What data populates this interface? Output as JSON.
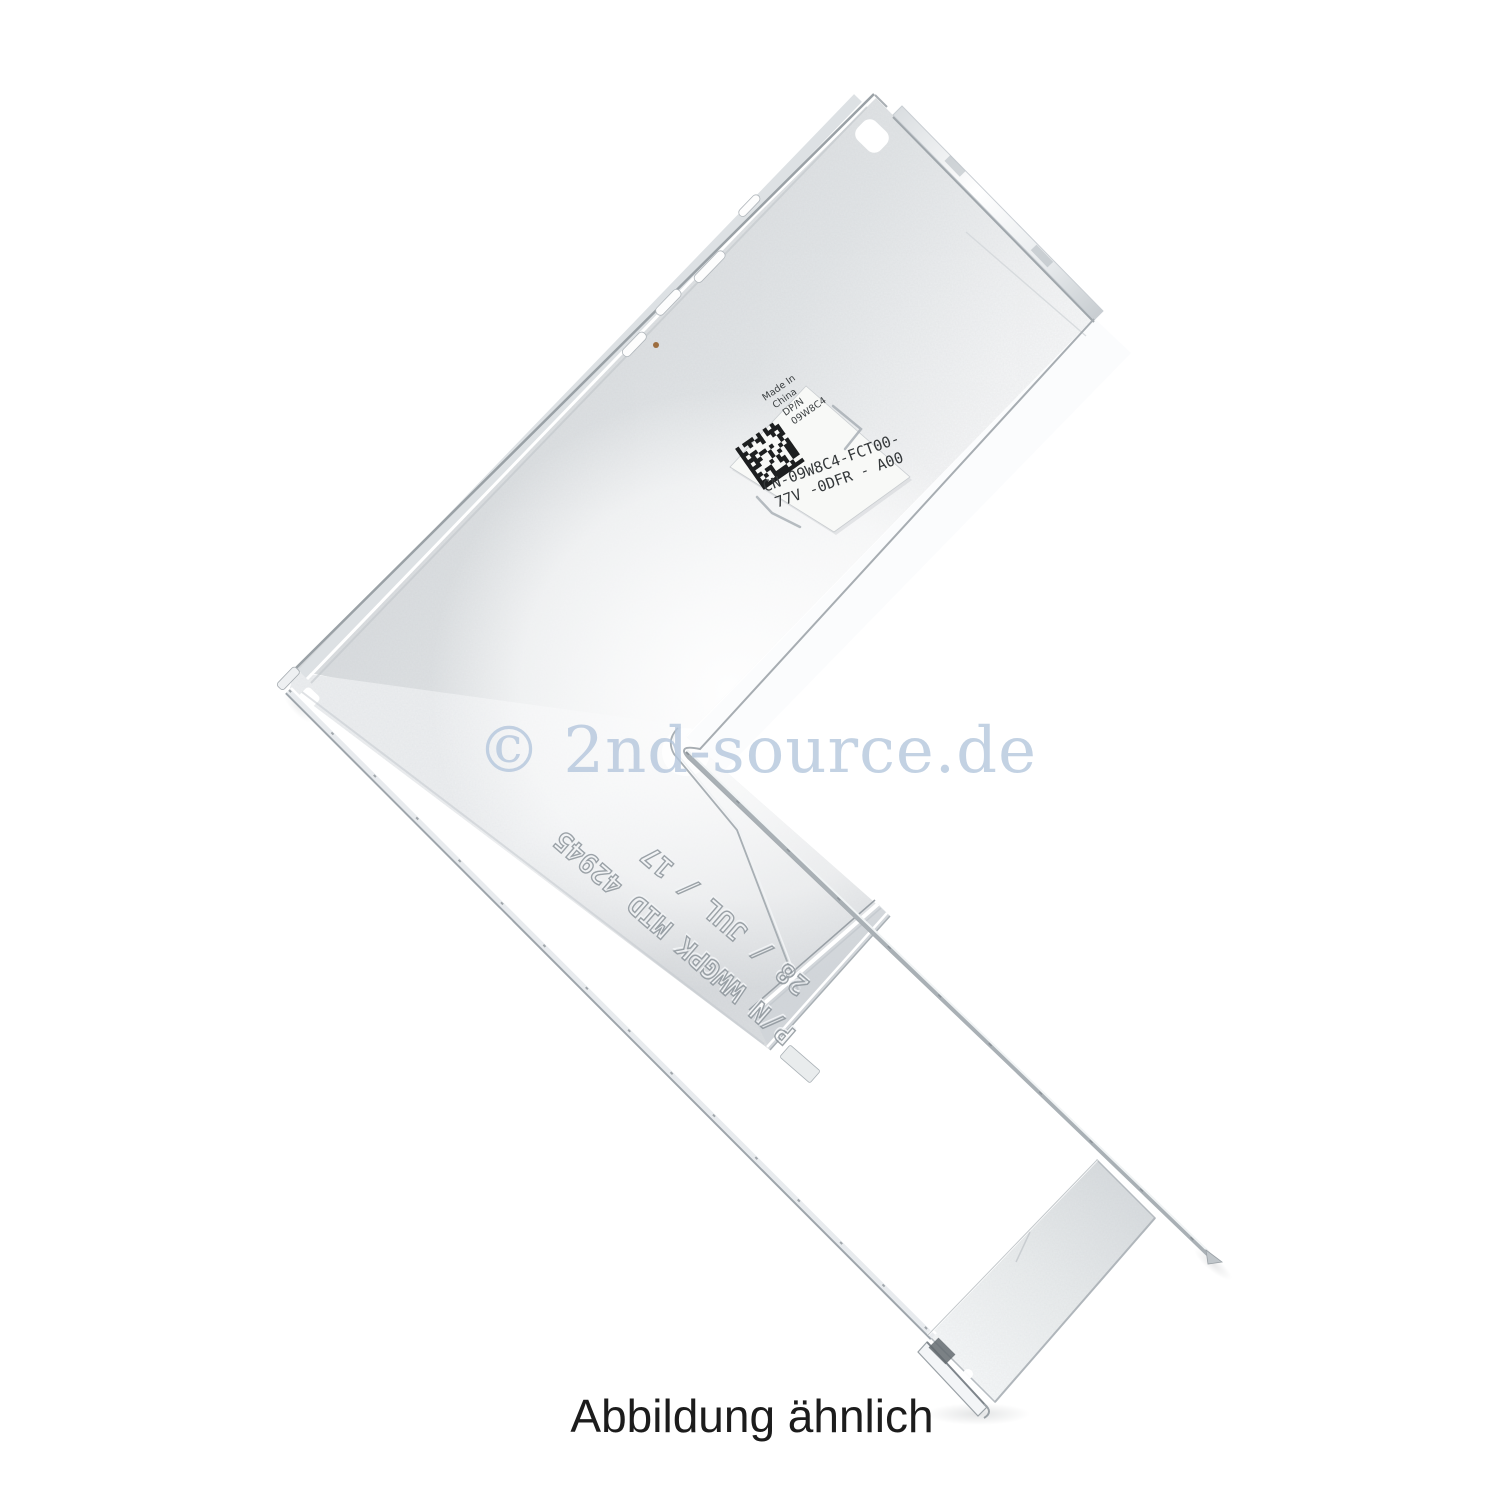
{
  "page": {
    "background_color": "#ffffff"
  },
  "watermark": {
    "text": "© 2nd-source.de",
    "color": "#b5c7dd"
  },
  "caption": {
    "text": "Abbildung ähnlich",
    "color": "#1c1c1c"
  },
  "bracket": {
    "subject": "Silver L-shaped sheet-metal server blank bracket photographed diagonally on white",
    "label": {
      "made_in_line1": "Made In",
      "made_in_line2": "China",
      "dpn_label": "DP/N",
      "dpn_value": "09W8C4",
      "part_line1": "CN-09W8C4-FCT00-",
      "part_line2": "77V -0DFR - A00",
      "barcode_type": "datamatrix"
    },
    "engraving": {
      "line1": "P/N WWGPK MID 42945",
      "line2": "28 / JUL / 17"
    },
    "colors": {
      "metal_light": "#e7eaec",
      "metal_mid": "#d6d9dc",
      "edge_gray": "#9aa1a6",
      "highlight": "#ffffff"
    }
  }
}
